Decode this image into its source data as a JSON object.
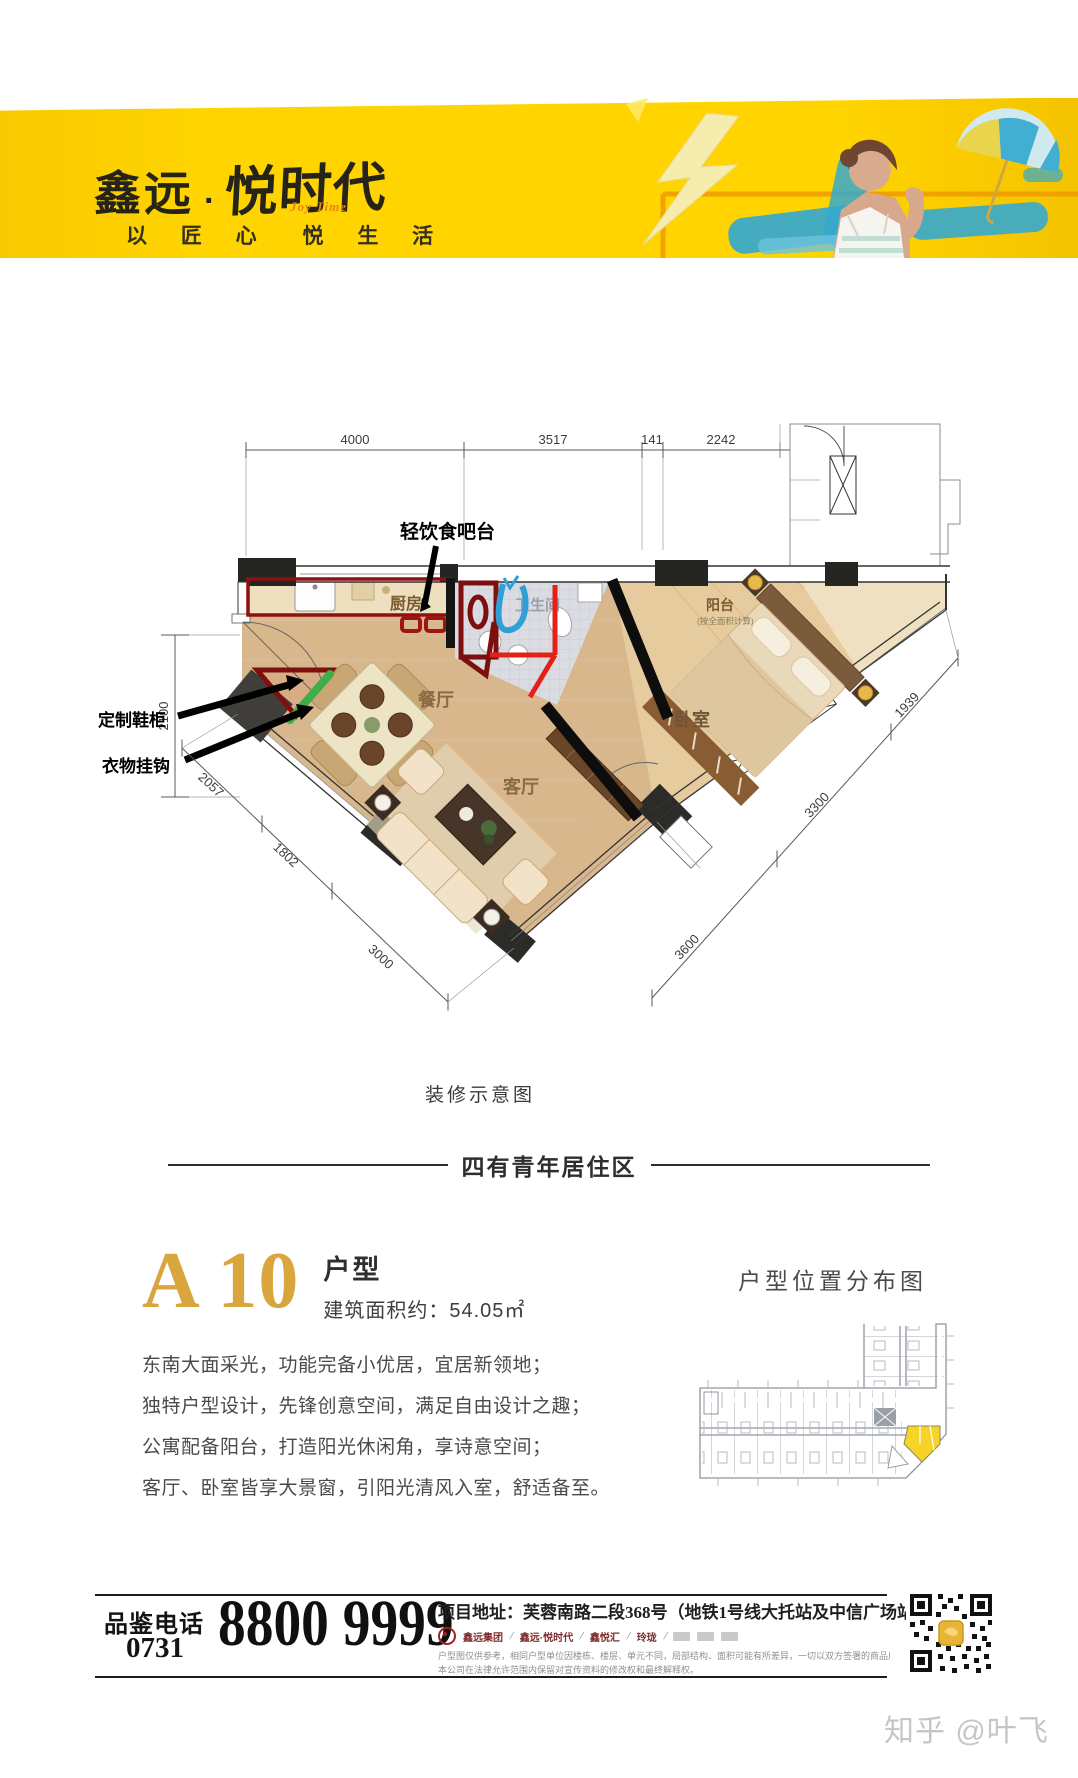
{
  "header": {
    "brand1": "鑫远",
    "dot": "·",
    "brand2": "悦时代",
    "joytime": "Joy Time",
    "tagline1": "以 匠 心",
    "tagline2": "悦 生 活"
  },
  "floorplan": {
    "dims_top": [
      "4000",
      "3517",
      "141",
      "2242",
      "1200"
    ],
    "dim_left": "2100",
    "dims_left_diag": [
      "2057",
      "1802",
      "3000"
    ],
    "dims_right_diag": [
      "1939",
      "3300",
      "3600"
    ],
    "rooms": {
      "kitchen": "厨房",
      "bath": "卫生间",
      "dining": "餐厅",
      "living": "客厅",
      "bedroom": "卧室",
      "balcony": "阳台",
      "balcony_note": "(按全面积计算)"
    },
    "annotations": {
      "bar": "轻饮食吧台",
      "shoe": "定制鞋柜",
      "hook": "衣物挂钩"
    },
    "caption": "装修示意图"
  },
  "divider": {
    "text": "四有青年居住区"
  },
  "unit": {
    "code": "A 10",
    "label": "户型",
    "area": "建筑面积约：54.05㎡"
  },
  "description": {
    "lines": [
      "东南大面采光，功能完备小优居，宜居新领地；",
      "独特户型设计，先锋创意空间，满足自由设计之趣；",
      "公寓配备阳台，打造阳光休闲角，享诗意空间；",
      "客厅、卧室皆享大景窗，引阳光清风入室，舒适备至。"
    ]
  },
  "locator": {
    "title": "户型位置分布图"
  },
  "footer": {
    "phone_label": "品鉴电话",
    "area_code": "0731",
    "phone": "8800 9999",
    "address": "项目地址：芙蓉南路二段368号（地铁1号线大托站及中信广场站旁）",
    "sep": "/",
    "brands": [
      "鑫远集团",
      "鑫远·悦时代",
      "鑫悦汇",
      "玲珑"
    ],
    "disclaimer1": "户型图仅供参考，相同户型单位因楼栋、楼层、单元不同，局部结构、面积可能有所差异，一切以双方签署的商品房买卖合同及政府审批文件为准。",
    "disclaimer2": "本公司在法律允许范围内保留对宣传资料的修改权和最终解释权。"
  },
  "watermark": {
    "text": "知乎 @叶飞"
  },
  "colors": {
    "banner_yellow": "#FFD400",
    "accent_gold": "#D9A63D",
    "annotation_red": "#E32119",
    "annotation_darkred": "#8E1111",
    "annotation_green": "#3FAE49",
    "annotation_blue": "#2F9FD6",
    "highlight_unit_yellow": "#F5D327",
    "wood_floor": "#D8B78C"
  }
}
